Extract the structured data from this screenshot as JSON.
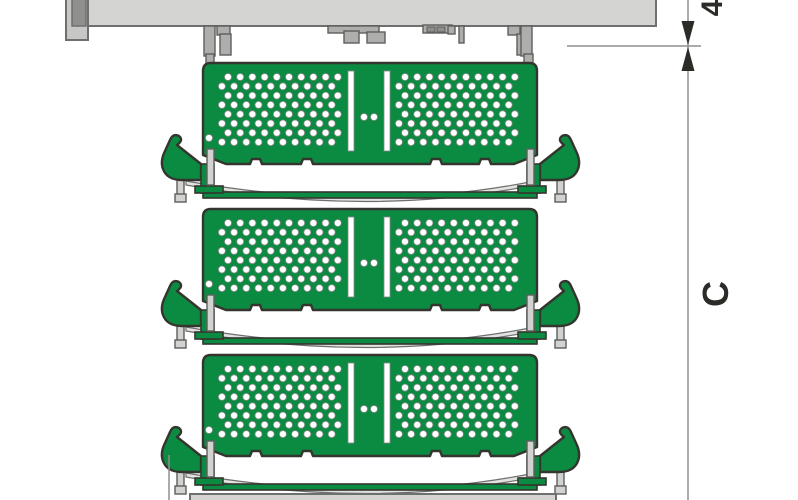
{
  "meta": {
    "description": "Technical side-view diagram: three stacked green perforated tray shelves suspended under a grey mounting rail, with vertical dimension annotations on the right"
  },
  "dimension_labels": {
    "tier_spacing": "4",
    "total_height": "C"
  },
  "colors": {
    "background": "#ffffff",
    "green": "#0b8b41",
    "outline": "#35352f",
    "beam_fill": "#d4d4d2",
    "beam_stroke": "#6f6f6f",
    "bracket_fill": "#aeaeac",
    "bracket_dark": "#8f8f8d",
    "bracket_light": "#c7c7c5",
    "bracket_stroke": "#5e5e5c",
    "strip_fill": "#d2d2d0",
    "band_fill": "#e2e2e0",
    "hole_fill": "#ffffff",
    "hole_stroke": "#8a8a8a",
    "dim_line": "#8f8f8f",
    "dim_text": "#2b2b28"
  },
  "trays": {
    "count": 3,
    "level_offsets": [
      0,
      146,
      292
    ],
    "hole_grid": {
      "rows": 8,
      "cols": 10,
      "dx": 12.2,
      "dy": 9.3,
      "r": 3.5,
      "stagger": -6.1
    }
  }
}
